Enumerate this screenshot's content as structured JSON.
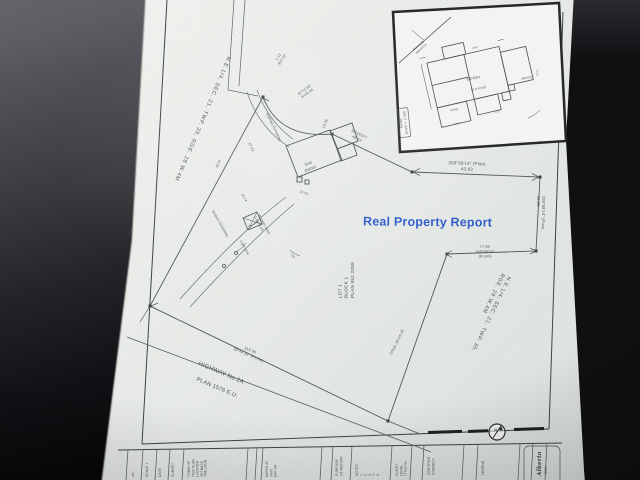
{
  "report_title": {
    "text": "Real Property Report",
    "color": "#2e5dcc"
  },
  "plan": {
    "sections": {
      "left": "N.E.1/4, SEC. 21, TWP. 35, RGE. 28    W.4M",
      "right": "N.E.1/4, SEC. 21, TWP. 35, RGE. 28    W.4M"
    },
    "lot": "LOT 1\nBLOCK 1\nPLAN 952 2259",
    "bearings": {
      "north": "359°58′14″ (Plan)\n43.63",
      "east": "269°58′14″ (Plan)\n39.05",
      "jog": "77.88\n359°58′14″\n(PLAN)",
      "northwest": "30°45′57″\n45.73",
      "corner": "2.12\n302°22′",
      "arc": "62°51′30″\nR=45.00",
      "southeast": "30°44′39″ (Plan)",
      "highway": "119.06\n30°44′39″ (PLAN)"
    },
    "highway": {
      "name": "HIGHWAY No.2A",
      "plan": "PLAN 1576 E.U."
    },
    "features": {
      "asphalt": "Asphalt Driveway",
      "gravel": "Gravel Driveway",
      "shed": "Wooden shed\n3.05×2.44",
      "light_pole": "Light pole",
      "see_detail": "See\nDetail"
    },
    "dims": {
      "d1": "37.51",
      "d2": "19.28",
      "d3": "13.45",
      "d4": "18.74",
      "d5": "15.92",
      "d6": "7.04"
    },
    "north_arrow": "N"
  },
  "inset": {
    "box_label": "Detail\nScale = 1:250",
    "labels": {
      "house": "HOUSE",
      "eave": "(Eave 0.6)",
      "deck": "Deck",
      "garage": "Garage",
      "driveway": "Concrete\nDriveway"
    },
    "dims": {
      "d1": "13.1",
      "d2": "6.10",
      "d3": "2.44",
      "d4": "24.0"
    }
  },
  "titleblock": {
    "c0": "No.",
    "c1": "SCALE 1:",
    "c2": "DATE",
    "c3": "SURVEY",
    "c4": "TOWN OF\nTHIS PLAN\nLOCATED\nSETBACK\nTHE LAND",
    "c6": "DATED AT\nTHIS\nDAY OF",
    "c7": "PURPOSE\nOF REPORT",
    "c8": "NOTES:\n1.\n2.\n3.\n4.\n5.",
    "c9": "CLIENT:\nLEGAL:\nTITLE No.",
    "c10": "CERTIFIED\nCORRECT",
    "c11": "LEGEND",
    "c12a": "Alberta",
    "c12b": "CMC"
  }
}
